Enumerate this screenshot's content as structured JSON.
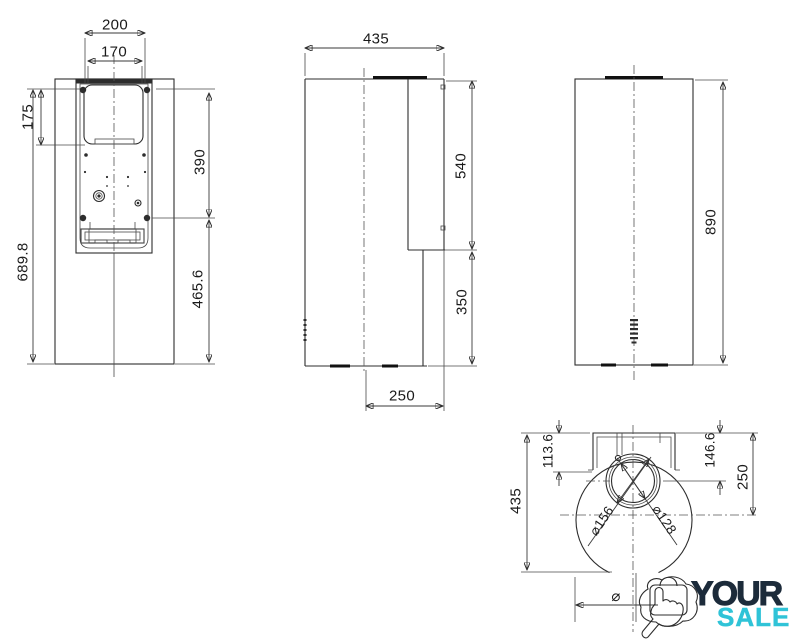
{
  "colors": {
    "line": "#2d2d2d",
    "dim_text": "#1a1a1a",
    "logo_navy": "#1c2b3a",
    "logo_teal": "#2fc3d7"
  },
  "dims": {
    "front_width_outer": "200",
    "front_width_inner": "170",
    "front_top_offset": "175",
    "front_height_total": "689.8",
    "front_plate_span": "390",
    "front_lower_span": "465.6",
    "side_depth": "435",
    "side_rear_upper": "540",
    "side_rear_lower": "350",
    "side_center_to_rear": "250",
    "back_height": "890",
    "top_height": "435",
    "top_offset_small": "113.6",
    "top_offset_mid": "146.6",
    "top_center_offset": "250",
    "duct_outer_dia": "⌀156",
    "duct_inner_dia": "⌀128",
    "bottom_dia_symbol": "⌀"
  },
  "logo": {
    "line1": "YOUR",
    "line2": "SALE"
  }
}
